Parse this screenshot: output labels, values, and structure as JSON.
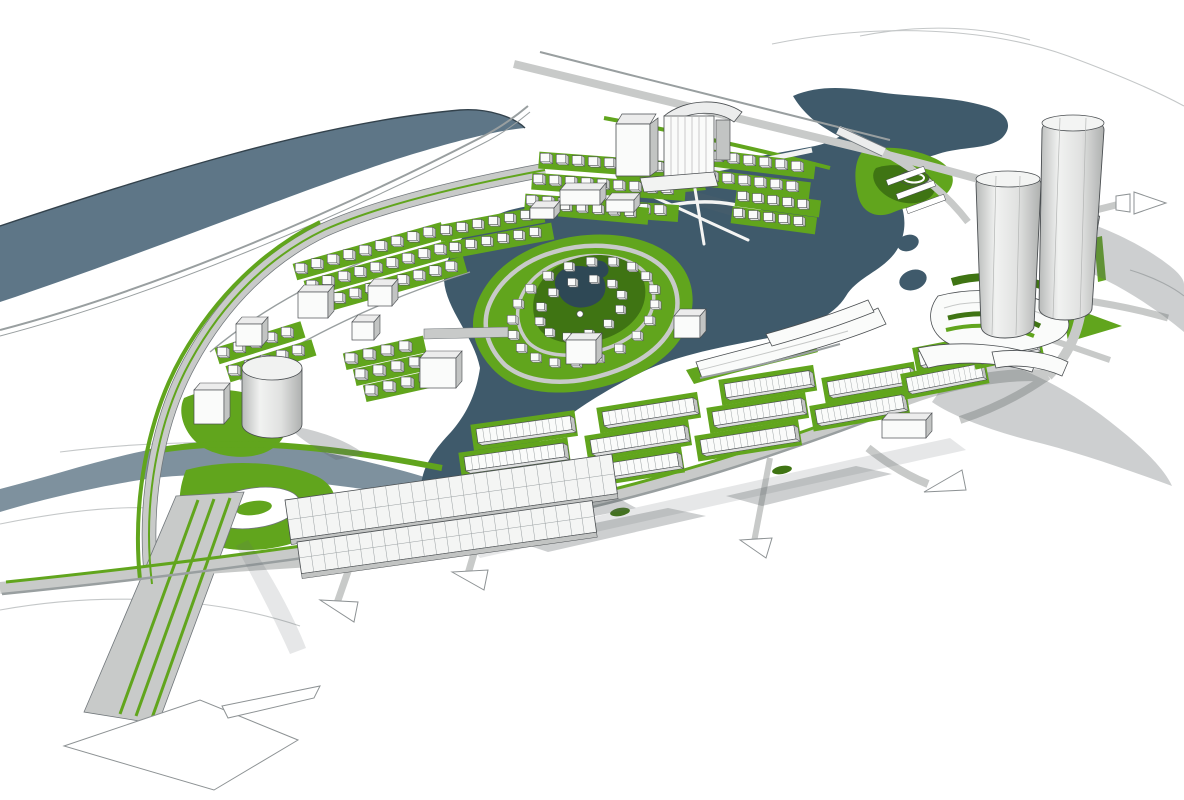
{
  "meta": {
    "title": "Urban waterfront masterplan - aerial 3D massing rendering",
    "description": "SketchUp-style aerial view of a planned lakeside district: central lake with a teardrop-shaped residential island, arcs of small white houses, rows of terraced blocks, two tall cylindrical towers at the east, a wide green-median boulevard at the south-west, a river band at the north-west and white directional road arrows."
  },
  "palette": {
    "bg": "#ffffff",
    "river": "#5e7687",
    "river_edge": "#33424c",
    "canal": "#7e919e",
    "lake": "#3f5a6b",
    "pond": "#2e4855",
    "green": "#61a51d",
    "green_dark": "#3f7413",
    "road": "#c8cac9",
    "road_dark": "#999fa0",
    "road_edge": "#70767a",
    "building": "#fafbfa",
    "building_side": "#c2c4c3",
    "building_top": "#ececec",
    "outline": "#4a4e51",
    "shadow": "rgba(100,106,110,0.32)",
    "shadow_light": "rgba(100,106,110,0.16)",
    "contour": "#c4c7c8",
    "arrow_stroke": "#8d9294"
  },
  "scene": {
    "house_grids": [
      {
        "x": 545,
        "y": 158,
        "cols": 9,
        "dx": 16,
        "dy": 1.2,
        "rows": 3,
        "rdx": -7,
        "rdy": 21,
        "s": 0.95
      },
      {
        "x": 700,
        "y": 154,
        "cols": 7,
        "dx": 16,
        "dy": 2,
        "rows": 2,
        "rdx": -5,
        "rdy": 20,
        "s": 0.95
      },
      {
        "x": 742,
        "y": 196,
        "cols": 5,
        "dx": 15,
        "dy": 2,
        "rows": 2,
        "rdx": -4,
        "rdy": 17,
        "s": 0.9
      },
      {
        "x": 300,
        "y": 268,
        "cols": 9,
        "dx": 16,
        "dy": -4.5,
        "rows": 3,
        "rdx": 11,
        "rdy": 17,
        "s": 0.95
      },
      {
        "x": 222,
        "y": 352,
        "cols": 5,
        "dx": 16,
        "dy": -5,
        "rows": 2,
        "rdx": 11,
        "rdy": 18,
        "s": 0.95
      },
      {
        "x": 350,
        "y": 358,
        "cols": 4,
        "dx": 18,
        "dy": -4,
        "rows": 3,
        "rdx": 10,
        "rdy": 16,
        "s": 1
      },
      {
        "x": 565,
        "y": 206,
        "cols": 5,
        "dx": 16,
        "dy": 1.5,
        "rows": 1,
        "rdx": 0,
        "rdy": 0,
        "s": 0.9
      },
      {
        "x": 445,
        "y": 230,
        "cols": 6,
        "dx": 16,
        "dy": -3,
        "rows": 2,
        "rdx": 9,
        "rdy": 17,
        "s": 0.9
      }
    ],
    "island_rings": [
      {
        "cx": 583,
        "cy": 312,
        "rx": 74,
        "ry": 48,
        "rot": -18,
        "count": 20,
        "s": 0.85
      },
      {
        "cx": 580,
        "cy": 308,
        "rx": 43,
        "ry": 27,
        "rot": -18,
        "count": 12,
        "s": 0.8
      }
    ],
    "rowblocks": [
      {
        "x": 452,
        "y": 485,
        "len": 100,
        "a": -8
      },
      {
        "x": 464,
        "y": 457,
        "len": 100,
        "a": -8
      },
      {
        "x": 476,
        "y": 429,
        "len": 95,
        "a": -8
      },
      {
        "x": 578,
        "y": 468,
        "len": 100,
        "a": -9
      },
      {
        "x": 590,
        "y": 440,
        "len": 95,
        "a": -9
      },
      {
        "x": 602,
        "y": 412,
        "len": 92,
        "a": -9
      },
      {
        "x": 700,
        "y": 440,
        "len": 95,
        "a": -9
      },
      {
        "x": 712,
        "y": 412,
        "len": 90,
        "a": -9
      },
      {
        "x": 724,
        "y": 384,
        "len": 86,
        "a": -9
      },
      {
        "x": 815,
        "y": 410,
        "len": 88,
        "a": -10
      },
      {
        "x": 827,
        "y": 382,
        "len": 84,
        "a": -10
      },
      {
        "x": 906,
        "y": 378,
        "len": 76,
        "a": -11
      },
      {
        "x": 918,
        "y": 352,
        "len": 72,
        "a": -11
      },
      {
        "x": 976,
        "y": 348,
        "len": 60,
        "a": -12
      },
      {
        "x": 986,
        "y": 324,
        "len": 56,
        "a": -12
      }
    ],
    "halls": [
      {
        "x": 285,
        "y": 500,
        "len": 330,
        "h": 40,
        "a": -8,
        "ribs": 26
      },
      {
        "x": 297,
        "y": 542,
        "len": 298,
        "h": 32,
        "a": -8,
        "ribs": 24
      }
    ],
    "cubes": [
      {
        "x": 298,
        "y": 292,
        "w": 30,
        "h": 26
      },
      {
        "x": 368,
        "y": 286,
        "w": 24,
        "h": 20
      },
      {
        "x": 420,
        "y": 358,
        "w": 36,
        "h": 30
      },
      {
        "x": 236,
        "y": 324,
        "w": 26,
        "h": 22
      },
      {
        "x": 194,
        "y": 390,
        "w": 30,
        "h": 34
      },
      {
        "x": 560,
        "y": 190,
        "w": 40,
        "h": 15
      },
      {
        "x": 606,
        "y": 200,
        "w": 28,
        "h": 12
      },
      {
        "x": 530,
        "y": 208,
        "w": 24,
        "h": 11
      },
      {
        "x": 566,
        "y": 340,
        "w": 30,
        "h": 24
      },
      {
        "x": 674,
        "y": 316,
        "w": 26,
        "h": 22
      },
      {
        "x": 882,
        "y": 420,
        "w": 44,
        "h": 18
      },
      {
        "x": 352,
        "y": 322,
        "w": 22,
        "h": 18
      }
    ]
  }
}
